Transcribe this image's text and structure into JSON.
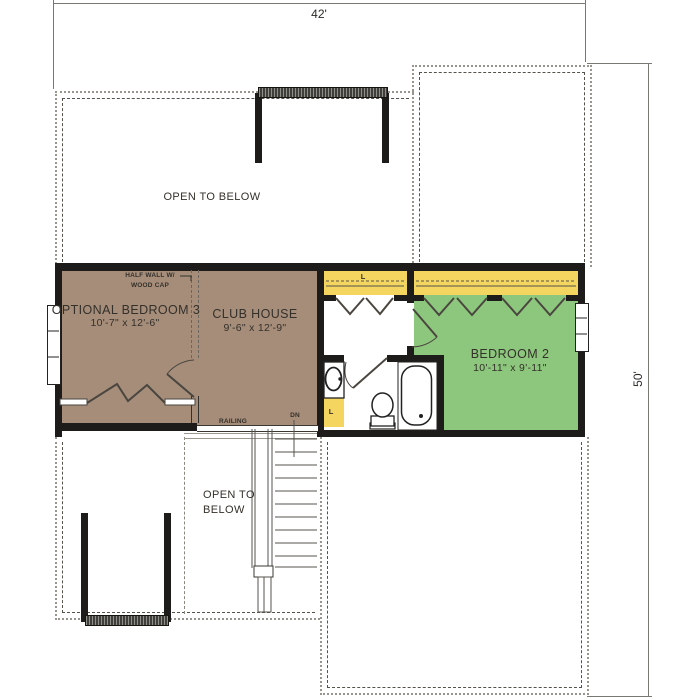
{
  "plan": {
    "dimensions": {
      "width": "42'",
      "height": "50'"
    },
    "rooms": {
      "optional_bedroom_3": {
        "name": "OPTIONAL BEDROOM 3",
        "size": "10'-7\" x 12'-6\""
      },
      "club_house": {
        "name": "CLUB HOUSE",
        "size": "9'-6\" x 12'-9\""
      },
      "bedroom_2": {
        "name": "BEDROOM 2",
        "size": "10'-11\" x 9'-11\""
      }
    },
    "labels": {
      "open_to_below_upper": "OPEN TO BELOW",
      "open_to_below_lower": "OPEN TO BELOW",
      "half_wall_note": "HALF WALL W/ WOOD CAP",
      "railing": "RAILING",
      "down": "DN",
      "linen_closet": "L"
    },
    "colors": {
      "wall": "#1D1C1A",
      "bedroom_fill_brown": "#A58D7A",
      "bedroom_fill_green": "#8DC77D",
      "closet_fill_yellow": "#F3D560"
    }
  }
}
